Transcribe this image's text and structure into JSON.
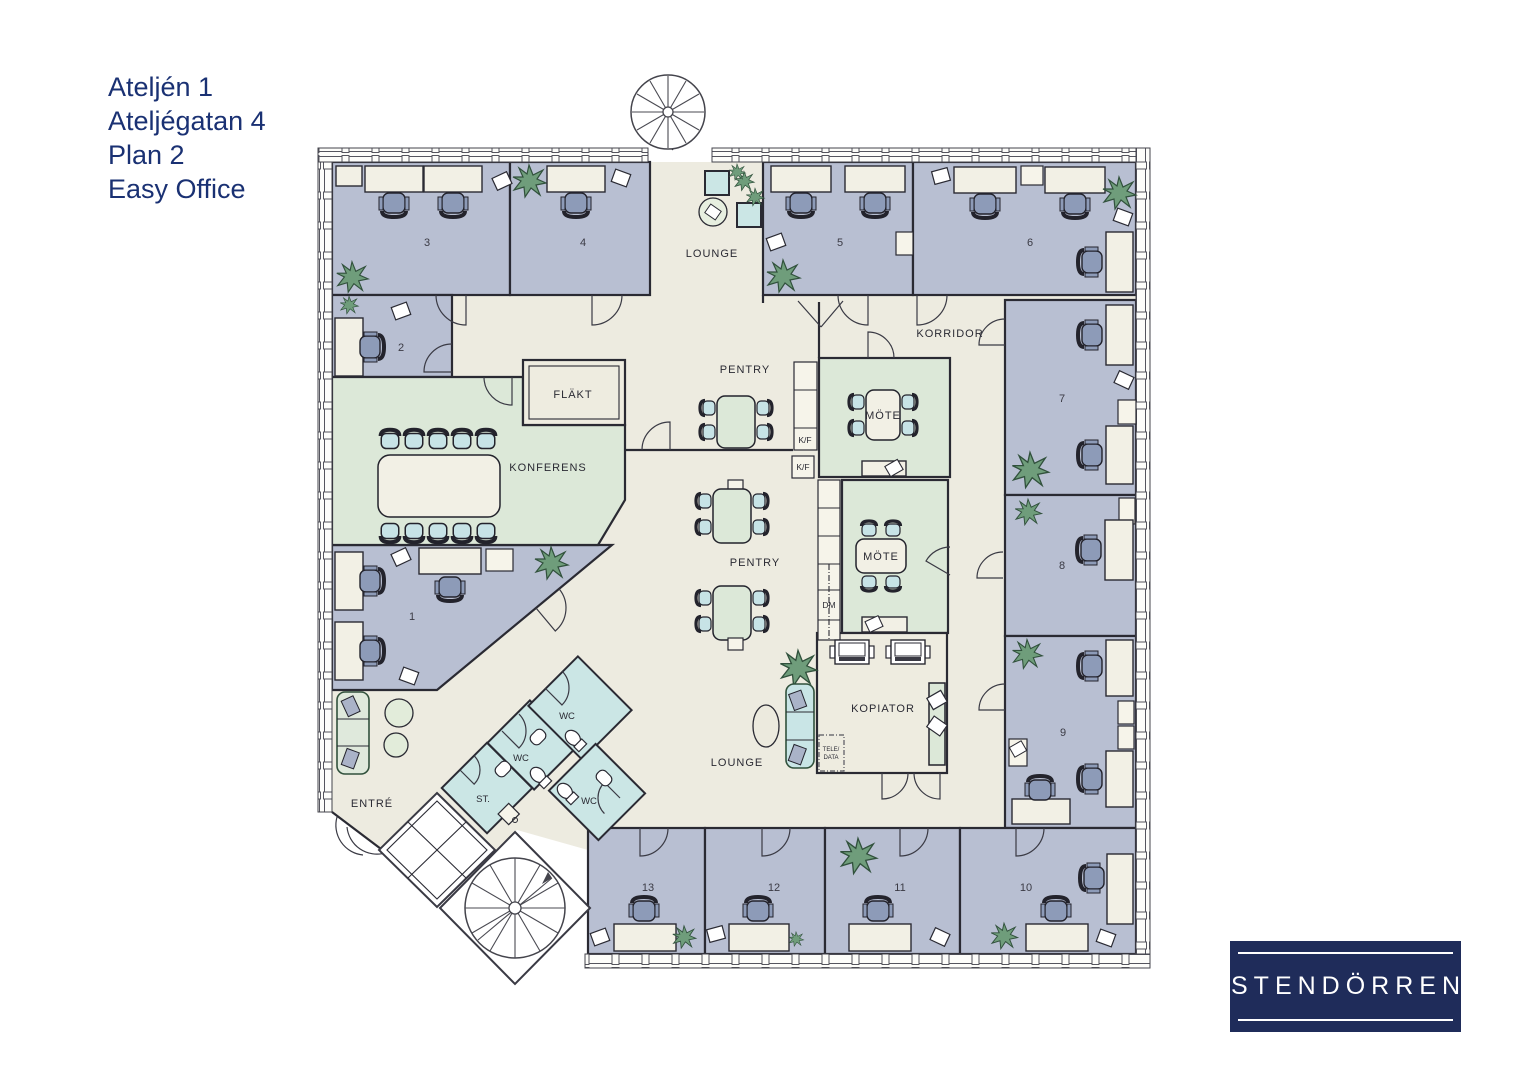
{
  "title": {
    "lines": [
      "Ateljén 1",
      "Ateljégatan 4",
      "Plan 2",
      "Easy Office"
    ]
  },
  "floorplan": {
    "rooms": {
      "r1": "1",
      "r2": "2",
      "r3": "3",
      "r4": "4",
      "r5": "5",
      "r6": "6",
      "r7": "7",
      "r8": "8",
      "r9": "9",
      "r10": "10",
      "r11": "11",
      "r12": "12",
      "r13": "13"
    },
    "labels": {
      "lounge_top": "LOUNGE",
      "korridor": "KORRIDOR",
      "pentry_upper": "PENTRY",
      "mote_upper": "MÖTE",
      "kf_upper": "K/F",
      "kf_lower": "K/F",
      "konferens": "KONFERENS",
      "flakt": "FLÄKT",
      "pentry_lower": "PENTRY",
      "mote_lower": "MÖTE",
      "dm": "DM",
      "kopiator": "KOPIATOR",
      "tele_line1": "TELE/",
      "tele_line2": "DATA",
      "lounge_bottom": "LOUNGE",
      "wc_top": "WC",
      "wc_mid": "WC",
      "wc_bottom": "WC",
      "st": "ST.",
      "entre": "ENTRÉ"
    },
    "colors": {
      "office_room": "#b8bfd2",
      "meeting_room": "#dce8d8",
      "wc_room": "#cbe6e5",
      "common_floor": "#edebe0",
      "wall": "#2a2a33",
      "plant_green": "#6f9d7b",
      "chair_blue": "#8d9bb8",
      "logo_navy": "#1f2c5a",
      "title_text": "#1a3173"
    }
  },
  "logo": {
    "text": "STENDÖRREN"
  }
}
